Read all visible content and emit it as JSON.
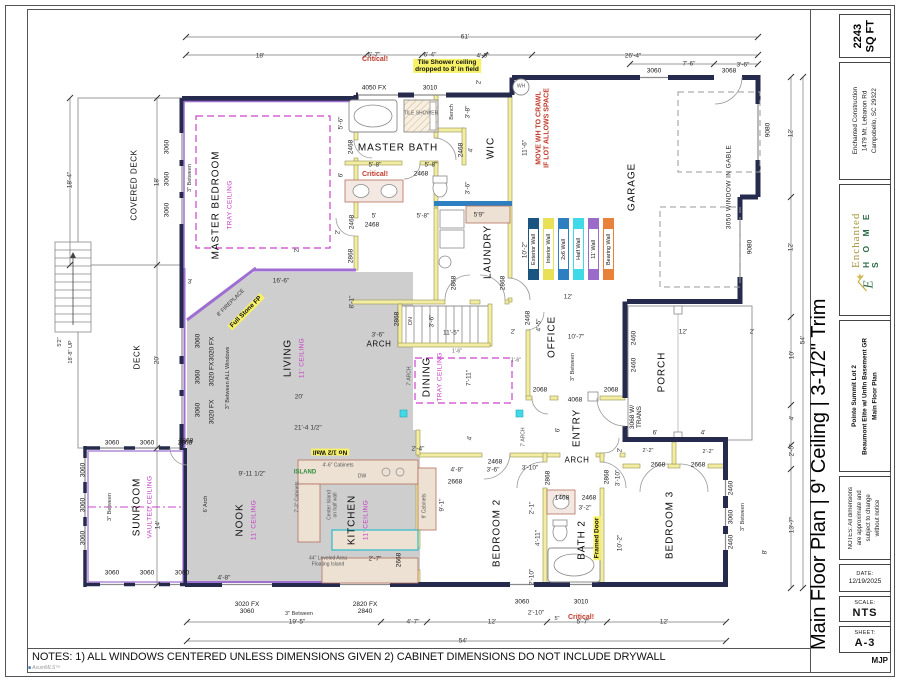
{
  "title_block": {
    "area": "2243\nSQ FT",
    "company": "Enchanted Construction\n1479 Mt. Lebanon Rd\nCampobello, SC 29322",
    "logo": {
      "name": "Enchanted",
      "sub": "H O M E S"
    },
    "project": "Pointe Summit Lot 2\nBeaumont Elite w/ Unfin Basement GR\nMain Floor Plan",
    "disclaimer": "NOTES: All dimensions\nare approximate and\nsubject to change\nwithout notice",
    "date_label": "DATE:",
    "date": "12/19/2025",
    "scale_label": "SCALE:",
    "scale": "NTS",
    "sheet_label": "SHEET:",
    "sheet": "A-3",
    "initials": "MJP"
  },
  "page": {
    "side_title": "Main Floor Plan | 9' Ceiling | 3-1/2\" Trim",
    "bottom_notes": "NOTES: 1) ALL WINDOWS CENTERED UNLESS DIMENSIONS GIVEN 2) CABINET DIMENSIONS DO NOT INCLUDE DRYWALL",
    "watermark": "AxumMLS™"
  },
  "legend": {
    "items": [
      {
        "label": "Exterior Wall",
        "color": "#1a5480"
      },
      {
        "label": "Interior Wall",
        "color": "#e8e157"
      },
      {
        "label": "2x6 Wall",
        "color": "#2e7fc1"
      },
      {
        "label": "Half Wall",
        "color": "#3fd9e8"
      },
      {
        "label": "11' Wall",
        "color": "#9b6bc9"
      },
      {
        "label": "Bearing Wall",
        "color": "#e8813a"
      }
    ]
  },
  "plan": {
    "labels": [
      [
        "61'",
        465,
        37,
        0,
        "dim"
      ],
      [
        "18'",
        260,
        56,
        0,
        "dim"
      ],
      [
        "5'-7\"",
        374,
        55,
        0,
        "dim"
      ],
      [
        "6'-4\"",
        430,
        55,
        0,
        "dim"
      ],
      [
        "4'-9\"",
        483,
        56,
        0,
        "dim"
      ],
      [
        "26'-4\"",
        633,
        56,
        0,
        "dim"
      ],
      [
        "7'-6\"",
        689,
        64,
        0,
        "dim"
      ],
      [
        "3'-6\"",
        743,
        65,
        0,
        "dim"
      ],
      [
        "3060",
        654,
        71,
        0,
        "win"
      ],
      [
        "3068",
        729,
        71,
        0,
        "win"
      ],
      [
        "18'-4\"",
        70,
        180,
        -90,
        "dim"
      ],
      [
        "COVERED DECK",
        135,
        185,
        -90,
        "rsm"
      ],
      [
        "18'",
        157,
        182,
        -90,
        "dim"
      ],
      [
        "3060",
        167,
        147,
        -90,
        "win"
      ],
      [
        "3060",
        167,
        179,
        -90,
        "win"
      ],
      [
        "3060",
        167,
        210,
        -90,
        "win"
      ],
      [
        "3\" Between",
        190,
        178,
        -90,
        "tiny"
      ],
      [
        "5'2\"",
        60,
        342,
        -90,
        "tiny"
      ],
      [
        "18'-8\" UP",
        71,
        352,
        -90,
        "tiny"
      ],
      [
        "DECK",
        138,
        357,
        -90,
        "rsm"
      ],
      [
        "20'",
        157,
        360,
        -90,
        "dim"
      ],
      [
        "3'",
        190,
        282,
        0,
        "dim"
      ],
      [
        "MASTER BEDROOM",
        216,
        205,
        -90,
        "room"
      ],
      [
        "TRAY CEILING",
        230,
        205,
        -90,
        "mag"
      ],
      [
        "5'-6\"",
        341,
        123,
        -90,
        "dim"
      ],
      [
        "6'",
        341,
        175,
        -90,
        "dim"
      ],
      [
        "2'",
        338,
        232,
        -90,
        "dim"
      ],
      [
        "2468",
        351,
        147,
        -90,
        "win"
      ],
      [
        "2468",
        352,
        222,
        -90,
        "win"
      ],
      [
        "2868",
        351,
        256,
        -90,
        "win"
      ],
      [
        "2'",
        297,
        250,
        -90,
        "dim"
      ],
      [
        "Critical!",
        375,
        60,
        0,
        "red"
      ],
      [
        "Tile Shower ceiling\ndropped to 8' in field",
        447,
        66,
        0,
        "yhl"
      ],
      [
        "4050 FX",
        374,
        88,
        0,
        "win"
      ],
      [
        "3010",
        430,
        88,
        0,
        "win"
      ],
      [
        "2'",
        479,
        82,
        -90,
        "dim"
      ],
      [
        "TILE SHOWER",
        421,
        114,
        0,
        "t6"
      ],
      [
        "Bench",
        452,
        112,
        -90,
        "tiny"
      ],
      [
        "3'-8\"",
        468,
        112,
        -90,
        "dim"
      ],
      [
        "MASTER BATH",
        398,
        148,
        0,
        "room"
      ],
      [
        "2468",
        461,
        150,
        -90,
        "win"
      ],
      [
        "4'",
        471,
        150,
        -90,
        "dim"
      ],
      [
        "5'-8\"",
        375,
        165,
        0,
        "dim"
      ],
      [
        "5'-8\"",
        431,
        165,
        0,
        "dim"
      ],
      [
        "2468",
        421,
        174,
        0,
        "win"
      ],
      [
        "Critical!",
        375,
        175,
        0,
        "red"
      ],
      [
        "3'-6\"",
        468,
        188,
        -90,
        "dim"
      ],
      [
        "5'",
        374,
        216,
        0,
        "dim"
      ],
      [
        "2468",
        372,
        225,
        0,
        "win"
      ],
      [
        "5'-8\"",
        423,
        216,
        0,
        "dim"
      ],
      [
        "5'9\"",
        479,
        215,
        0,
        "dim"
      ],
      [
        "WH",
        521,
        87,
        0,
        "t6"
      ],
      [
        "WIC",
        491,
        148,
        -90,
        "room"
      ],
      [
        "11'-6\"",
        525,
        148,
        -90,
        "dim"
      ],
      [
        "MOVE WH TO CRAWL\nIF LOT ALLOWS SPACE",
        543,
        128,
        -90,
        "red"
      ],
      [
        "LAUNDRY",
        488,
        252,
        -90,
        "room"
      ],
      [
        "10'-2\"",
        525,
        250,
        -90,
        "dim"
      ],
      [
        "2868",
        454,
        283,
        -90,
        "win"
      ],
      [
        "2868",
        503,
        283,
        -90,
        "win"
      ],
      [
        "12'",
        568,
        297,
        0,
        "dim"
      ],
      [
        "GARAGE",
        632,
        187,
        -90,
        "room"
      ],
      [
        "3050 WINDOW IN GABLE",
        729,
        187,
        -90,
        "rxs"
      ],
      [
        "9080",
        768,
        130,
        -90,
        "win"
      ],
      [
        "9080",
        750,
        247,
        -90,
        "win"
      ],
      [
        "12'",
        791,
        133,
        -90,
        "dim"
      ],
      [
        "12'",
        791,
        247,
        -90,
        "dim"
      ],
      [
        "LIVING",
        288,
        358,
        -90,
        "room"
      ],
      [
        "11' CEILING",
        302,
        358,
        -90,
        "mag"
      ],
      [
        "8' FIREPLACE",
        231,
        303,
        -45,
        "tiny"
      ],
      [
        "Full Stone FP",
        246,
        312,
        -45,
        "yhl"
      ],
      [
        "16'-6\"",
        281,
        281,
        0,
        "dim"
      ],
      [
        "8'-1\"",
        352,
        302,
        -90,
        "dim"
      ],
      [
        "3'-6\"",
        378,
        335,
        0,
        "dim"
      ],
      [
        "ARCH",
        379,
        345,
        0,
        "rsm"
      ],
      [
        "2868",
        397,
        319,
        -90,
        "win"
      ],
      [
        "20'",
        299,
        397,
        0,
        "dim"
      ],
      [
        "21'-4 1/2\"",
        308,
        428,
        0,
        "dim"
      ],
      [
        "3020 FX",
        212,
        349,
        -90,
        "win"
      ],
      [
        "3020 FX",
        212,
        374,
        -90,
        "win"
      ],
      [
        "3020 FX",
        212,
        412,
        -90,
        "win"
      ],
      [
        "3060",
        198,
        341,
        -90,
        "win"
      ],
      [
        "3060",
        198,
        377,
        -90,
        "win"
      ],
      [
        "3060",
        198,
        410,
        -90,
        "win"
      ],
      [
        "3\" Between ALL Windows",
        228,
        378,
        -90,
        "tiny"
      ],
      [
        "No 1/2 Wall",
        330,
        452,
        180,
        "yhl"
      ],
      [
        "2868",
        186,
        441,
        0,
        "win"
      ],
      [
        "DINING",
        427,
        377,
        -90,
        "room"
      ],
      [
        "TRAY CEILING",
        440,
        377,
        -90,
        "mag"
      ],
      [
        "7'-11\"",
        469,
        378,
        -90,
        "dim"
      ],
      [
        "DN",
        411,
        321,
        -90,
        "tiny"
      ],
      [
        "3'-6\"",
        432,
        321,
        -90,
        "dim"
      ],
      [
        "11'-5\"",
        451,
        333,
        0,
        "dim"
      ],
      [
        "2'",
        513,
        332,
        0,
        "dim"
      ],
      [
        "2468",
        528,
        318,
        -90,
        "win"
      ],
      [
        "4'-5\"",
        539,
        325,
        -90,
        "dim"
      ],
      [
        "1'-6\"",
        457,
        352,
        0,
        "t6"
      ],
      [
        "1'-6\"",
        516,
        361,
        0,
        "t6"
      ],
      [
        "7' ARCH",
        410,
        376,
        -90,
        "t6"
      ],
      [
        "7' ARCH",
        524,
        437,
        -90,
        "t6"
      ],
      [
        "4'",
        470,
        438,
        -90,
        "dim"
      ],
      [
        "2'-4\"",
        418,
        449,
        0,
        "dim"
      ],
      [
        "OFFICE",
        552,
        337,
        -90,
        "room"
      ],
      [
        "10'-7\"",
        576,
        337,
        0,
        "dim"
      ],
      [
        "3\" Between",
        573,
        367,
        -90,
        "tiny"
      ],
      [
        "2068",
        540,
        390,
        0,
        "win"
      ],
      [
        "2068",
        611,
        390,
        0,
        "win"
      ],
      [
        "4068",
        575,
        400,
        0,
        "win"
      ],
      [
        "ENTRY",
        577,
        428,
        -90,
        "room"
      ],
      [
        "6'",
        558,
        430,
        -90,
        "dim"
      ],
      [
        "ARCH",
        577,
        461,
        0,
        "rsm"
      ],
      [
        "3068 W/\nTRANS",
        636,
        417,
        -90,
        "win"
      ],
      [
        "6'",
        655,
        433,
        0,
        "dim"
      ],
      [
        "4'",
        703,
        433,
        0,
        "dim"
      ],
      [
        "PORCH",
        662,
        372,
        -90,
        "room"
      ],
      [
        "12'",
        683,
        332,
        0,
        "dim"
      ],
      [
        "2'",
        752,
        332,
        0,
        "dim"
      ],
      [
        "2460",
        634,
        338,
        -90,
        "win"
      ],
      [
        "2460",
        634,
        365,
        -90,
        "win"
      ],
      [
        "2'",
        620,
        450,
        -90,
        "dim"
      ],
      [
        "2'-2\"",
        648,
        451,
        0,
        "tiny"
      ],
      [
        "2'-2\"",
        708,
        452,
        0,
        "tiny"
      ],
      [
        "2668",
        658,
        465,
        0,
        "win"
      ],
      [
        "2668",
        698,
        465,
        0,
        "win"
      ],
      [
        "NOOK",
        240,
        520,
        -90,
        "room"
      ],
      [
        "11' CEILING",
        254,
        520,
        -90,
        "mag"
      ],
      [
        "KITCHEN",
        352,
        520,
        -90,
        "room"
      ],
      [
        "11' CEILING",
        366,
        520,
        -90,
        "mag"
      ],
      [
        "9'-11 1/2\"",
        252,
        474,
        0,
        "dim"
      ],
      [
        "6' Arch",
        206,
        504,
        -90,
        "tiny"
      ],
      [
        "ISLAND",
        305,
        473,
        0,
        "grn"
      ],
      [
        "4'-6\" Cabinets",
        338,
        466,
        0,
        "t6"
      ],
      [
        "DW",
        362,
        477,
        0,
        "t6"
      ],
      [
        "Center Island\non half wall",
        333,
        505,
        -90,
        "t6"
      ],
      [
        "7'-3\" Cabinets",
        298,
        497,
        -90,
        "t6"
      ],
      [
        "44\" Leveled Area\nFloating Island",
        328,
        562,
        0,
        "t6"
      ],
      [
        "2'-7\"",
        375,
        559,
        0,
        "dim"
      ],
      [
        "2668",
        399,
        560,
        -90,
        "win"
      ],
      [
        "4'-8\"",
        224,
        578,
        0,
        "dim"
      ],
      [
        "9' Cabinets",
        425,
        506,
        -90,
        "t6"
      ],
      [
        "9'-1\"",
        442,
        505,
        -90,
        "dim"
      ],
      [
        "3020 FX\n3060",
        247,
        608,
        0,
        "win"
      ],
      [
        "3\" Between",
        299,
        614,
        0,
        "tiny"
      ],
      [
        "2820 FX\n2840",
        365,
        608,
        0,
        "win"
      ],
      [
        "3060",
        522,
        602,
        0,
        "win"
      ],
      [
        "2'-10\"",
        536,
        613,
        0,
        "dim"
      ],
      [
        "3010",
        581,
        602,
        0,
        "win"
      ],
      [
        "Critical!",
        581,
        618,
        0,
        "red"
      ],
      [
        "BEDROOM 2",
        497,
        533,
        -90,
        "room"
      ],
      [
        "4'-8\"",
        457,
        470,
        0,
        "dim"
      ],
      [
        "3'-6\"",
        493,
        470,
        0,
        "dim"
      ],
      [
        "3'-10\"",
        530,
        468,
        0,
        "dim"
      ],
      [
        "2668",
        455,
        482,
        0,
        "win"
      ],
      [
        "2468",
        495,
        462,
        0,
        "win"
      ],
      [
        "2868",
        548,
        478,
        -90,
        "win"
      ],
      [
        "2868",
        607,
        477,
        -90,
        "win"
      ],
      [
        "3'-10\"",
        618,
        478,
        -90,
        "dim"
      ],
      [
        "1468",
        562,
        498,
        0,
        "win"
      ],
      [
        "2468",
        589,
        498,
        0,
        "win"
      ],
      [
        "3'-2\"",
        585,
        508,
        0,
        "dim"
      ],
      [
        "2'-1\"",
        532,
        508,
        -90,
        "dim"
      ],
      [
        "4'-11\"",
        538,
        538,
        -90,
        "dim"
      ],
      [
        "2'-10\"",
        532,
        577,
        -90,
        "dim"
      ],
      [
        "BATH 2",
        582,
        540,
        -90,
        "room"
      ],
      [
        "Framed Door",
        597,
        538,
        -90,
        "yhl"
      ],
      [
        "10'-2\"",
        620,
        543,
        -90,
        "dim"
      ],
      [
        "BEDROOM 3",
        670,
        525,
        -90,
        "room"
      ],
      [
        "2460",
        731,
        488,
        -90,
        "win"
      ],
      [
        "3060",
        731,
        517,
        -90,
        "win"
      ],
      [
        "2460",
        731,
        542,
        -90,
        "win"
      ],
      [
        "3\" Between",
        743,
        517,
        -90,
        "tiny"
      ],
      [
        "8'",
        765,
        552,
        -90,
        "dim"
      ],
      [
        "19'-5\"",
        297,
        622,
        0,
        "dim"
      ],
      [
        "4'-7\"",
        413,
        622,
        0,
        "dim"
      ],
      [
        "12'",
        492,
        622,
        0,
        "dim"
      ],
      [
        "5\"",
        557,
        619,
        0,
        "tiny"
      ],
      [
        "5'-7\"",
        583,
        622,
        0,
        "dim"
      ],
      [
        "12'",
        664,
        622,
        0,
        "dim"
      ],
      [
        "54'",
        463,
        641,
        0,
        "dim"
      ],
      [
        "54'",
        803,
        340,
        -90,
        "dim"
      ],
      [
        "10'",
        792,
        355,
        -90,
        "dim"
      ],
      [
        "4'",
        792,
        418,
        -90,
        "dim"
      ],
      [
        "2'-5\"",
        792,
        450,
        -90,
        "dim"
      ],
      [
        "13'-7\"",
        792,
        525,
        -90,
        "dim"
      ],
      [
        "SUNROOM",
        137,
        507,
        -90,
        "room"
      ],
      [
        "VAULTED CEILING",
        150,
        507,
        -90,
        "mag"
      ],
      [
        "14'",
        158,
        525,
        -90,
        "dim"
      ],
      [
        "3060",
        112,
        443,
        0,
        "win"
      ],
      [
        "3060",
        147,
        443,
        0,
        "win"
      ],
      [
        "2868",
        185,
        443,
        0,
        "win"
      ],
      [
        "3060",
        83,
        470,
        -90,
        "win"
      ],
      [
        "3060",
        83,
        505,
        -90,
        "win"
      ],
      [
        "3060",
        83,
        538,
        -90,
        "win"
      ],
      [
        "3\" Between",
        110,
        507,
        -90,
        "tiny"
      ],
      [
        "3060",
        112,
        573,
        0,
        "win"
      ],
      [
        "3060",
        147,
        573,
        0,
        "win"
      ],
      [
        "3060",
        182,
        573,
        0,
        "win"
      ]
    ]
  }
}
